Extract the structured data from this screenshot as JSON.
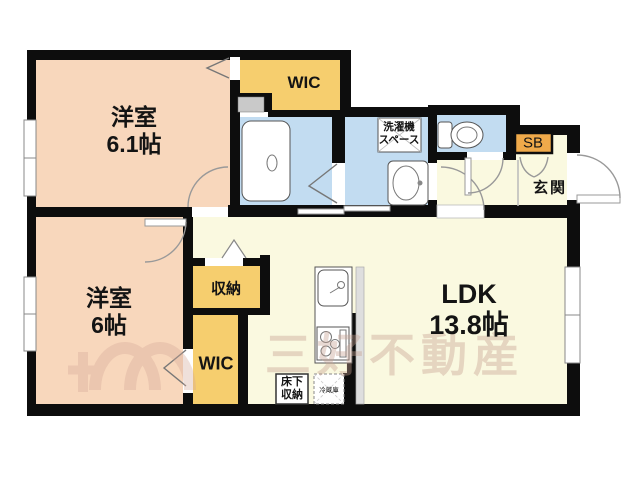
{
  "plan_title": "floor-plan",
  "rooms": {
    "bedroom_upper": {
      "name": "洋室",
      "size": "6.1帖"
    },
    "bedroom_lower": {
      "name": "洋室",
      "size": "6帖"
    },
    "ldk": {
      "name": "LDK",
      "size": "13.8帖"
    },
    "wic_upper": {
      "name": "WIC"
    },
    "wic_lower": {
      "name": "WIC"
    },
    "storage": {
      "name": "収納"
    },
    "laundry_space": {
      "line1": "洗濯機",
      "line2": "スペース"
    },
    "shoe_box": {
      "name": "SB"
    },
    "entrance": {
      "name": "玄関"
    },
    "underfloor_storage": {
      "line1": "床下",
      "line2": "収納"
    },
    "refrigerator": {
      "name": "冷蔵庫"
    }
  },
  "fixtures": [
    "bathtub",
    "toilet",
    "washbasin",
    "kitchen-sink",
    "stove",
    "refrigerator"
  ],
  "watermark": {
    "text": "三好不動産"
  },
  "colors": {
    "room_peach": "#F8D7BC",
    "closet_yellow": "#F6CE6E",
    "wet_blue": "#C2DCF1",
    "floor_cream": "#FAF9E0",
    "shoebox_orange": "#EFA94A",
    "wall": "#0d0d0d"
  }
}
